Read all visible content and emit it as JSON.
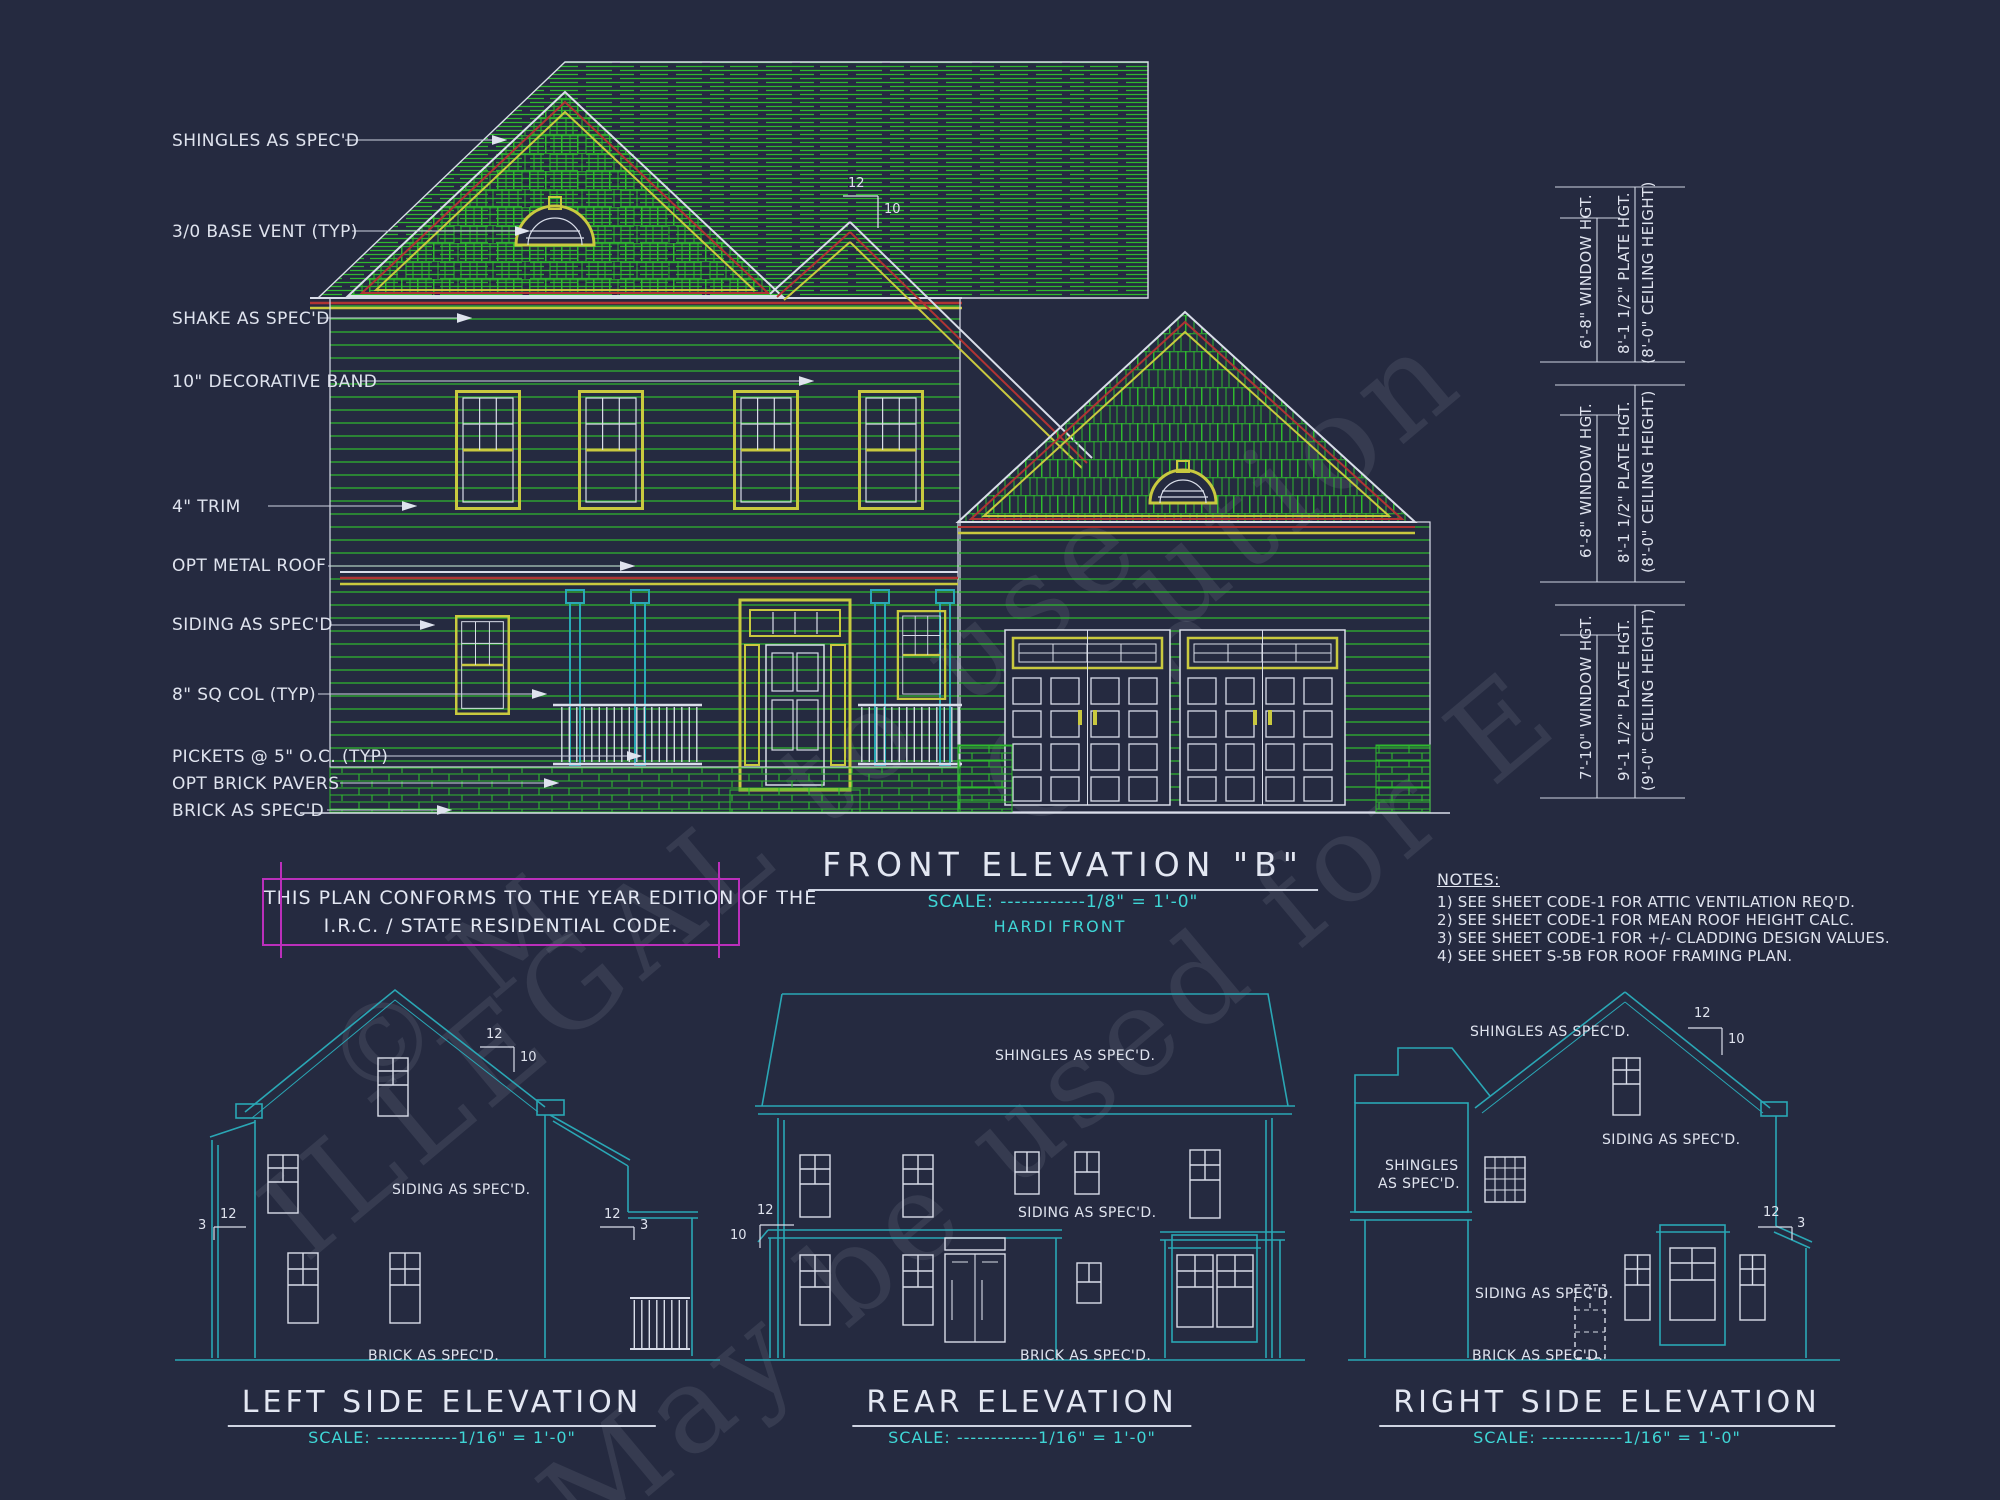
{
  "front": {
    "title": "FRONT ELEVATION \"B\"",
    "scale": "SCALE: ------------1/8\" = 1'-0\"",
    "subtitle": "HARDI FRONT",
    "pitch": {
      "rise": "12",
      "run": "10"
    },
    "callouts": [
      "SHINGLES AS SPEC'D",
      "3/0 BASE VENT (TYP)",
      "SHAKE AS SPEC'D",
      "10\" DECORATIVE BAND",
      "4\" TRIM",
      "OPT METAL ROOF",
      "SIDING AS SPEC'D",
      "8\" SQ COL (TYP)",
      "PICKETS @ 5\" O.C. (TYP)",
      "OPT BRICK PAVERS",
      "BRICK AS SPEC'D"
    ]
  },
  "code_box": {
    "line1": "THIS PLAN CONFORMS TO THE YEAR EDITION OF THE",
    "line2": "I.R.C. / STATE RESIDENTIAL CODE."
  },
  "notes": {
    "heading": "NOTES:",
    "items": [
      "1)  SEE SHEET CODE-1 FOR ATTIC VENTILATION REQ'D.",
      "2)  SEE SHEET CODE-1 FOR MEAN ROOF HEIGHT CALC.",
      "3)  SEE SHEET CODE-1 FOR +/- CLADDING DESIGN VALUES.",
      "4)  SEE SHEET S-5B FOR ROOF FRAMING PLAN."
    ]
  },
  "dims": [
    {
      "window": "6'-8\" WINDOW HGT.",
      "plate": "8'-1 1/2\" PLATE HGT.",
      "ceiling": "(8'-0\" CEILING HEIGHT)"
    },
    {
      "window": "6'-8\" WINDOW HGT.",
      "plate": "8'-1 1/2\" PLATE HGT.",
      "ceiling": "(8'-0\" CEILING HEIGHT)"
    },
    {
      "window": "7'-10\" WINDOW HGT.",
      "plate": "9'-1 1/2\" PLATE HGT.",
      "ceiling": "(9'-0\" CEILING HEIGHT)"
    }
  ],
  "left_elev": {
    "title": "LEFT SIDE ELEVATION",
    "scale": "SCALE: ------------1/16\" = 1'-0\"",
    "siding": "SIDING AS SPEC'D.",
    "brick": "BRICK AS SPEC'D.",
    "pitch_main": {
      "rise": "12",
      "run": "10"
    },
    "pitch_left": {
      "rise": "12",
      "run": "3"
    },
    "pitch_right": {
      "rise": "12",
      "run": "3"
    }
  },
  "rear_elev": {
    "title": "REAR ELEVATION",
    "scale": "SCALE: ------------1/16\" = 1'-0\"",
    "shingles": "SHINGLES AS SPEC'D.",
    "siding": "SIDING AS SPEC'D.",
    "brick": "BRICK AS SPEC'D.",
    "pitch": {
      "rise": "12",
      "run": "10"
    }
  },
  "right_elev": {
    "title": "RIGHT SIDE ELEVATION",
    "scale": "SCALE: ------------1/16\" = 1'-0\"",
    "shingles_top": "SHINGLES AS SPEC'D.",
    "shingles_l1": "SHINGLES",
    "shingles_l2": "AS SPEC'D.",
    "siding_top": "SIDING AS SPEC'D.",
    "siding_bottom": "SIDING AS SPEC'D.",
    "brick": "BRICK AS SPEC'D.",
    "pitch_main": {
      "rise": "12",
      "run": "10"
    },
    "pitch_porch": {
      "rise": "12",
      "run": "3"
    }
  },
  "watermark": [
    "© M",
    "ILLEGAL to use",
    "May be used for E",
    "ution",
    "Con"
  ]
}
